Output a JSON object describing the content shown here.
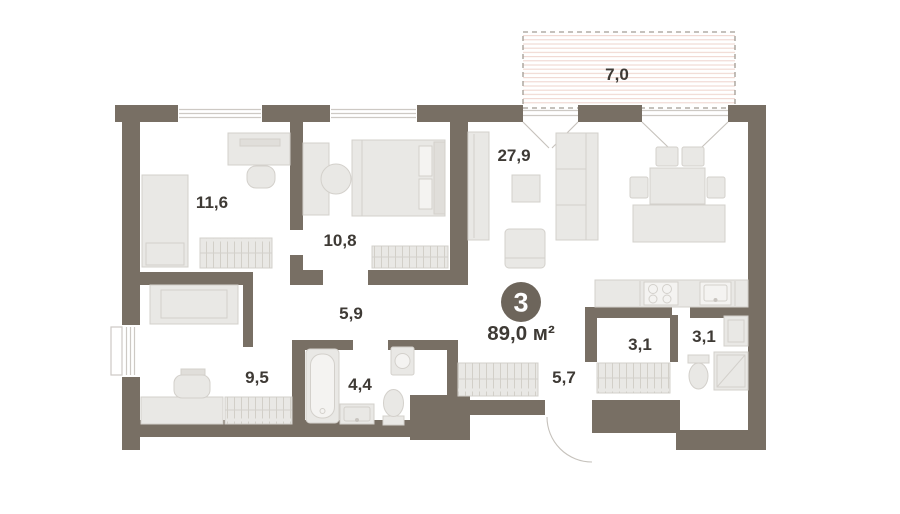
{
  "badge": {
    "rooms_count": "3",
    "total_area": "89,0 м²"
  },
  "rooms": [
    {
      "key": "bedroom-top-left",
      "area": "11,6"
    },
    {
      "key": "bedroom-top-middle",
      "area": "10,8"
    },
    {
      "key": "living-kitchen",
      "area": "27,9"
    },
    {
      "key": "corridor",
      "area": "5,9"
    },
    {
      "key": "bedroom-bottom-left",
      "area": "9,5"
    },
    {
      "key": "bathroom",
      "area": "4,4"
    },
    {
      "key": "hallway",
      "area": "5,7"
    },
    {
      "key": "storage",
      "area": "3,1"
    },
    {
      "key": "wc",
      "area": "3,1"
    },
    {
      "key": "balcony",
      "area": "7,0"
    }
  ],
  "colors": {
    "background": "#ffffff",
    "wall": "#786f64",
    "furniture_fill": "#e9e8e5",
    "furniture_alt": "#e0deda",
    "furniture_stroke": "#d3d0cb",
    "appliance_fill": "#f4f3f1",
    "wardrobe_hatch": "#cfccc6",
    "balcony_hatch": "#f0d7d0",
    "balcony_outline": "#a29c93",
    "window_frame": "#cdc9c4",
    "door_swing": "#c6c2bc",
    "label_text": "#3e3a35",
    "badge_bg": "#6d655b",
    "badge_text": "#ffffff"
  }
}
